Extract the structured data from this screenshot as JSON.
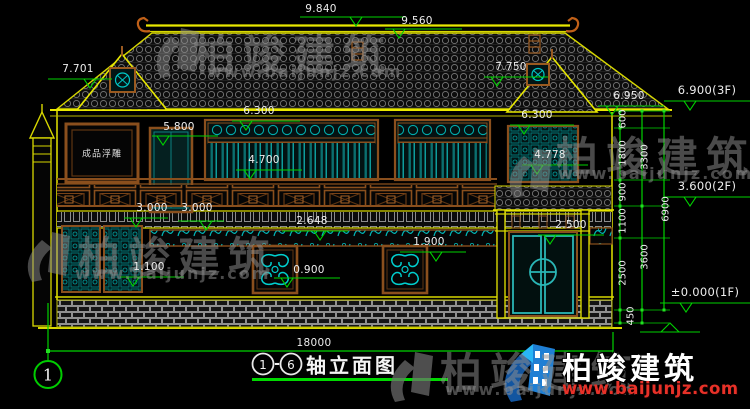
{
  "watermark": {
    "brand": "柏竣建筑",
    "url": "www.baijunjz.com"
  },
  "logo": {
    "brand": "柏竣建筑",
    "url": "www.baijunjz.com"
  },
  "drawing": {
    "relief_panel_label": "成品浮雕",
    "axis_bubble": "1",
    "title_block": {
      "start": "1",
      "dash": "-",
      "end": "6",
      "name": "轴立面图"
    },
    "dims": {
      "ridge_left": "9.840",
      "ridge_right": "9.560",
      "gable_left": "7.701",
      "gable_right": "7.750",
      "eave_right": "6.950",
      "level_3f": "6.900(3F)",
      "level_2f": "3.600(2F)",
      "level_1f": "±0.000(1F)",
      "win_band_left": "6.300",
      "win_band_right": "6.300",
      "door_2f": "5.800",
      "win_2f": "4.700",
      "win_wing": "4.778",
      "bay_a": "3.000",
      "bay_b": "3.000",
      "porch": "2.648",
      "entry_door": "2.500",
      "panel_right": "1.900",
      "panel_left": "1.100",
      "scroll_panel": "0.900",
      "v600": "600",
      "v1800": "1800",
      "v900": "900",
      "v1100": "1100",
      "v2500": "2500",
      "v3300": "3300",
      "v3600": "3600",
      "v6900": "6900",
      "v450": "450",
      "total_width": "18000"
    }
  }
}
